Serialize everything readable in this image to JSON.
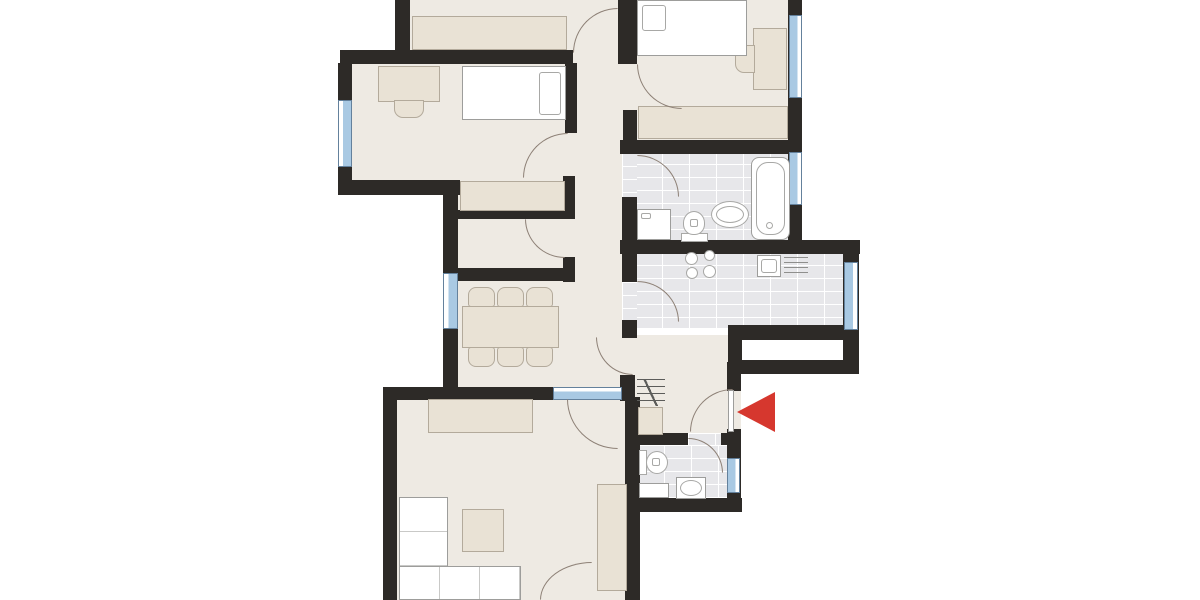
{
  "canvas": {
    "width": 1200,
    "height": 600
  },
  "colors": {
    "wall": "#2d2a27",
    "floor_beige": "#eeeae3",
    "tile": "#e7e7ea",
    "furniture_beige": "#e9e2d5",
    "furniture_beige_border": "#b3aa9b",
    "furniture_white": "#ffffff",
    "furniture_white_border": "#9d9d9b",
    "door_arc": "#8d8076",
    "window_blue": "#a9c9e3",
    "window_frame": "#64819c",
    "entrance_arrow_red": "#d6372e"
  },
  "floors": [
    {
      "name": "room-top-floor",
      "x": 408,
      "y": 0,
      "w": 212,
      "h": 52,
      "tile": false
    },
    {
      "name": "door-gap-top-room",
      "x": 573,
      "y": 44,
      "w": 45,
      "h": 22,
      "tile": false
    },
    {
      "name": "room-bedroom1-floor",
      "x": 350,
      "y": 60,
      "w": 222,
      "h": 125,
      "tile": false
    },
    {
      "name": "room-bedroom1-alcove-floor",
      "x": 455,
      "y": 178,
      "w": 112,
      "h": 36,
      "tile": false
    },
    {
      "name": "hallway-floor",
      "x": 575,
      "y": 60,
      "w": 52,
      "h": 330,
      "tile": false
    },
    {
      "name": "door-gap-bedroom1",
      "x": 565,
      "y": 133,
      "w": 12,
      "h": 43,
      "tile": false
    },
    {
      "name": "room-bedroom2-floor",
      "x": 635,
      "y": 0,
      "w": 155,
      "h": 140,
      "tile": false
    },
    {
      "name": "door-gap-bedroom2",
      "x": 623,
      "y": 64,
      "w": 14,
      "h": 46,
      "tile": false
    },
    {
      "name": "room-bathroom-floor",
      "x": 635,
      "y": 151,
      "w": 155,
      "h": 91,
      "tile": true
    },
    {
      "name": "door-gap-bathroom",
      "x": 622,
      "y": 153,
      "w": 15,
      "h": 44,
      "tile": true
    },
    {
      "name": "room-kitchen-floor",
      "x": 635,
      "y": 252,
      "w": 210,
      "h": 76,
      "tile": true
    },
    {
      "name": "door-gap-kitchen",
      "x": 622,
      "y": 282,
      "w": 15,
      "h": 38,
      "tile": true
    },
    {
      "name": "room-storage-floor",
      "x": 456,
      "y": 217,
      "w": 110,
      "h": 53,
      "tile": false
    },
    {
      "name": "door-gap-storage",
      "x": 563,
      "y": 219,
      "w": 12,
      "h": 38,
      "tile": false
    },
    {
      "name": "room-dining-floor",
      "x": 455,
      "y": 279,
      "w": 120,
      "h": 110,
      "tile": false
    },
    {
      "name": "room-vestibule-floor",
      "x": 635,
      "y": 335,
      "w": 95,
      "h": 100,
      "tile": false
    },
    {
      "name": "door-gap-vestibule",
      "x": 622,
      "y": 337,
      "w": 15,
      "h": 38,
      "tile": false
    },
    {
      "name": "door-gap-entrance",
      "x": 727,
      "y": 391,
      "w": 14,
      "h": 40,
      "tile": false
    },
    {
      "name": "room-wc-floor",
      "x": 637,
      "y": 445,
      "w": 90,
      "h": 53,
      "tile": true
    },
    {
      "name": "door-gap-wc",
      "x": 688,
      "y": 433,
      "w": 33,
      "h": 12,
      "tile": true
    },
    {
      "name": "room-living-floor",
      "x": 397,
      "y": 397,
      "w": 228,
      "h": 203,
      "tile": false
    }
  ],
  "walls": [
    {
      "x": 395,
      "y": 0,
      "w": 15,
      "h": 57
    },
    {
      "x": 340,
      "y": 50,
      "w": 233,
      "h": 14
    },
    {
      "x": 618,
      "y": 0,
      "w": 19,
      "h": 64
    },
    {
      "x": 338,
      "y": 63,
      "w": 14,
      "h": 124
    },
    {
      "x": 338,
      "y": 180,
      "w": 122,
      "h": 15
    },
    {
      "x": 443,
      "y": 182,
      "w": 15,
      "h": 215
    },
    {
      "x": 565,
      "y": 63,
      "w": 12,
      "h": 70
    },
    {
      "x": 563,
      "y": 176,
      "w": 12,
      "h": 42
    },
    {
      "x": 458,
      "y": 210,
      "w": 117,
      "h": 9
    },
    {
      "x": 563,
      "y": 257,
      "w": 12,
      "h": 25
    },
    {
      "x": 458,
      "y": 268,
      "w": 117,
      "h": 13
    },
    {
      "x": 620,
      "y": 140,
      "w": 182,
      "h": 14
    },
    {
      "x": 788,
      "y": 0,
      "w": 14,
      "h": 246
    },
    {
      "x": 622,
      "y": 197,
      "w": 15,
      "h": 48
    },
    {
      "x": 620,
      "y": 240,
      "w": 240,
      "h": 14
    },
    {
      "x": 622,
      "y": 254,
      "w": 15,
      "h": 28
    },
    {
      "x": 622,
      "y": 320,
      "w": 15,
      "h": 18
    },
    {
      "x": 843,
      "y": 254,
      "w": 16,
      "h": 120
    },
    {
      "x": 728,
      "y": 325,
      "w": 131,
      "h": 15
    },
    {
      "x": 728,
      "y": 360,
      "w": 131,
      "h": 14
    },
    {
      "x": 728,
      "y": 330,
      "w": 14,
      "h": 44
    },
    {
      "x": 620,
      "y": 375,
      "w": 15,
      "h": 26
    },
    {
      "x": 625,
      "y": 397,
      "w": 15,
      "h": 205
    },
    {
      "x": 727,
      "y": 362,
      "w": 14,
      "h": 29
    },
    {
      "x": 727,
      "y": 429,
      "w": 14,
      "h": 83
    },
    {
      "x": 630,
      "y": 433,
      "w": 58,
      "h": 12
    },
    {
      "x": 721,
      "y": 433,
      "w": 16,
      "h": 12
    },
    {
      "x": 625,
      "y": 498,
      "w": 117,
      "h": 14
    },
    {
      "x": 383,
      "y": 387,
      "w": 172,
      "h": 13
    },
    {
      "x": 383,
      "y": 387,
      "w": 14,
      "h": 213
    },
    {
      "x": 623,
      "y": 110,
      "w": 14,
      "h": 30
    }
  ],
  "windows": [
    {
      "name": "window-bedroom1-west",
      "x": 338,
      "y": 100,
      "w": 14,
      "h": 67,
      "blueSide": "right"
    },
    {
      "name": "window-bedroom2-east",
      "x": 789,
      "y": 15,
      "w": 13,
      "h": 83,
      "blueSide": "left"
    },
    {
      "name": "window-bathroom-east",
      "x": 789,
      "y": 152,
      "w": 13,
      "h": 53,
      "blueSide": "left"
    },
    {
      "name": "window-kitchen-east",
      "x": 844,
      "y": 262,
      "w": 14,
      "h": 68,
      "blueSide": "left"
    },
    {
      "name": "window-dining-west",
      "x": 443,
      "y": 273,
      "w": 15,
      "h": 56,
      "blueSide": "right"
    },
    {
      "name": "window-living-glazed-door",
      "x": 553,
      "y": 387,
      "w": 69,
      "h": 13,
      "blueSide": "bottom"
    },
    {
      "name": "window-wc-east",
      "x": 727,
      "y": 458,
      "w": 13,
      "h": 35,
      "blueSide": "left"
    }
  ],
  "doors": [
    {
      "name": "door-arc-top-room",
      "x": 573,
      "y": 8,
      "w": 45,
      "h": 45,
      "bulge": "tl"
    },
    {
      "name": "door-arc-bedroom1",
      "x": 523,
      "y": 133,
      "w": 45,
      "h": 45,
      "bulge": "tl"
    },
    {
      "name": "door-arc-bedroom2",
      "x": 637,
      "y": 64,
      "w": 45,
      "h": 45,
      "bulge": "bl"
    },
    {
      "name": "door-arc-bathroom",
      "x": 637,
      "y": 155,
      "w": 42,
      "h": 42,
      "bulge": "tr"
    },
    {
      "name": "door-arc-storage",
      "x": 525,
      "y": 219,
      "w": 40,
      "h": 39,
      "bulge": "bl"
    },
    {
      "name": "door-arc-kitchen",
      "x": 637,
      "y": 281,
      "w": 42,
      "h": 41,
      "bulge": "tr"
    },
    {
      "name": "door-arc-vestibule",
      "x": 596,
      "y": 337,
      "w": 37,
      "h": 38,
      "bulge": "bl"
    },
    {
      "name": "door-arc-living-glazed",
      "x": 567,
      "y": 399,
      "w": 51,
      "h": 50,
      "bulge": "bl"
    },
    {
      "name": "door-arc-entrance",
      "x": 690,
      "y": 389,
      "w": 43,
      "h": 43,
      "bulge": "tl"
    },
    {
      "name": "door-arc-wc",
      "x": 688,
      "y": 438,
      "w": 35,
      "h": 35,
      "bulge": "tr"
    },
    {
      "name": "door-arc-living-south",
      "x": 540,
      "y": 562,
      "w": 52,
      "h": 38,
      "bulge": "tl"
    }
  ],
  "furniture_beige": [
    {
      "name": "wardrobe-top-room",
      "x": 412,
      "y": 16,
      "w": 155,
      "h": 34
    },
    {
      "name": "desk-bedroom1",
      "x": 378,
      "y": 66,
      "w": 62,
      "h": 36
    },
    {
      "name": "chair-bedroom1",
      "x": 394,
      "y": 100,
      "w": 30,
      "h": 18,
      "r": "0 0 9px 9px"
    },
    {
      "name": "desk-bedroom2",
      "x": 753,
      "y": 28,
      "w": 34,
      "h": 62
    },
    {
      "name": "chair-bedroom2",
      "x": 735,
      "y": 45,
      "w": 20,
      "h": 28,
      "r": "9px 0 0 9px"
    },
    {
      "name": "wardrobe-bedroom2",
      "x": 638,
      "y": 106,
      "w": 150,
      "h": 33
    },
    {
      "name": "wardrobe-alcove",
      "x": 460,
      "y": 181,
      "w": 105,
      "h": 30
    },
    {
      "name": "dining-table",
      "x": 462,
      "y": 306,
      "w": 97,
      "h": 42
    },
    {
      "name": "dining-chair-1",
      "x": 468,
      "y": 287,
      "w": 27,
      "h": 20,
      "r": "8px 8px 3px 3px"
    },
    {
      "name": "dining-chair-2",
      "x": 497,
      "y": 287,
      "w": 27,
      "h": 20,
      "r": "8px 8px 3px 3px"
    },
    {
      "name": "dining-chair-3",
      "x": 526,
      "y": 287,
      "w": 27,
      "h": 20,
      "r": "8px 8px 3px 3px"
    },
    {
      "name": "dining-chair-4",
      "x": 468,
      "y": 347,
      "w": 27,
      "h": 20,
      "r": "3px 3px 8px 8px"
    },
    {
      "name": "dining-chair-5",
      "x": 497,
      "y": 347,
      "w": 27,
      "h": 20,
      "r": "3px 3px 8px 8px"
    },
    {
      "name": "dining-chair-6",
      "x": 526,
      "y": 347,
      "w": 27,
      "h": 20,
      "r": "3px 3px 8px 8px"
    },
    {
      "name": "hall-cabinet",
      "x": 638,
      "y": 407,
      "w": 25,
      "h": 28
    },
    {
      "name": "sideboard-living",
      "x": 428,
      "y": 399,
      "w": 105,
      "h": 34
    },
    {
      "name": "coffee-table",
      "x": 462,
      "y": 509,
      "w": 42,
      "h": 43
    },
    {
      "name": "media-unit-living",
      "x": 597,
      "y": 484,
      "w": 30,
      "h": 107
    }
  ],
  "furniture_white": [
    {
      "name": "wc-shelf",
      "x": 639,
      "y": 483,
      "w": 30,
      "h": 15
    },
    {
      "name": "entry-door-leaf",
      "x": 728,
      "y": 390,
      "w": 6,
      "h": 42
    },
    {
      "name": "sofa-chaise",
      "x": 399,
      "y": 497,
      "w": 49,
      "h": 103
    },
    {
      "name": "sofa-base",
      "x": 399,
      "y": 566,
      "w": 122,
      "h": 34
    }
  ],
  "fixtures": [
    {
      "name": "single-bed-bedroom1",
      "kind": "bed",
      "x": 462,
      "y": 66,
      "w": 104,
      "h": 54,
      "pillow": [
        76,
        5,
        22,
        43
      ]
    },
    {
      "name": "bed-bedroom2",
      "kind": "bed",
      "x": 637,
      "y": 0,
      "w": 110,
      "h": 56,
      "pillow": [
        4,
        4,
        24,
        26
      ]
    },
    {
      "name": "bathtub",
      "kind": "tub",
      "x": 751,
      "y": 157,
      "w": 39,
      "h": 83
    },
    {
      "name": "washing-machine",
      "kind": "washer",
      "x": 637,
      "y": 209,
      "w": 34,
      "h": 31
    },
    {
      "name": "toilet-bathroom",
      "kind": "toilet-up",
      "x": 681,
      "y": 211,
      "w": 27,
      "h": 31
    },
    {
      "name": "sink-bathroom",
      "kind": "sink-oval",
      "x": 711,
      "y": 201,
      "w": 38,
      "h": 27
    },
    {
      "name": "stove-burners",
      "kind": "burners",
      "x": 684,
      "y": 249,
      "w": 36,
      "h": 32
    },
    {
      "name": "kitchen-sink",
      "kind": "ksink",
      "x": 757,
      "y": 255,
      "w": 24,
      "h": 22
    },
    {
      "name": "kitchen-drainer",
      "kind": "drainer",
      "x": 784,
      "y": 257,
      "w": 24,
      "h": 19
    },
    {
      "name": "coat-rack",
      "kind": "coatrack",
      "x": 637,
      "y": 379,
      "w": 28,
      "h": 27
    },
    {
      "name": "toilet-wc",
      "kind": "toilet-right",
      "x": 639,
      "y": 450,
      "w": 30,
      "h": 25
    },
    {
      "name": "sink-wc",
      "kind": "sink-rect",
      "x": 676,
      "y": 477,
      "w": 30,
      "h": 22
    }
  ],
  "entrance_arrow": {
    "name": "entrance-arrow",
    "x": 737,
    "y": 392,
    "half": 20,
    "len": 38
  }
}
